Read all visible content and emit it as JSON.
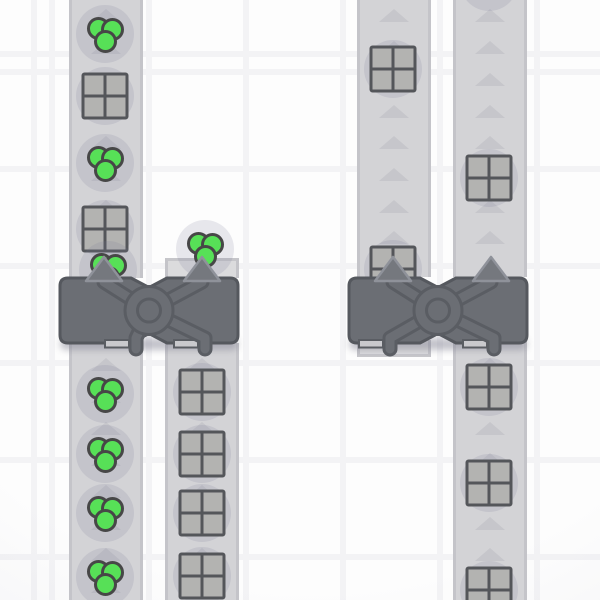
{
  "scene": {
    "title": "factory-belt-scene",
    "tile_size": 97,
    "grid": {
      "vertical_line_xs": [
        52,
        149,
        246,
        343,
        440,
        537
      ],
      "horizontal_line_ys": [
        60,
        157,
        254,
        351,
        448,
        545
      ],
      "line_width": 6,
      "cell_color": "#fdfdfd",
      "line_color": "#f3f3f5"
    },
    "colors": {
      "belt_fill": "#d3d3d6",
      "belt_edge": "#c4c4c9",
      "belt_stub_fill": "#dbdbdd",
      "belt_arrow": "#c6c6cb",
      "item_shadow": "rgba(120,120,148,0.16)",
      "green_item_fill": "#57e057",
      "green_item_outline": "#474747",
      "square_item_fill": "#b3b3b1",
      "square_item_line": "#54565a",
      "balancer_body": "#6b6e74",
      "balancer_outline": "#55585e",
      "balancer_pipe_outline": "#5a5d63",
      "balancer_arrow_fill": "#75787e",
      "balancer_arrow_outline": "#8f929a",
      "balancer_acceptor_fill": "#c9c9cd"
    },
    "arrows": {
      "phase": 10,
      "spacing": 31.7,
      "width": 30,
      "height": 13,
      "direction": "up"
    },
    "belts": [
      {
        "id": "conveyor-belt-1",
        "x": 69,
        "width": 74,
        "segments": [
          {
            "y": 0,
            "h": 278,
            "kind": "belt"
          },
          {
            "y": 343,
            "h": 257,
            "kind": "belt"
          }
        ]
      },
      {
        "id": "conveyor-belt-2",
        "x": 165,
        "width": 74,
        "segments": [
          {
            "y": 258,
            "h": 20,
            "kind": "stub-top"
          },
          {
            "y": 343,
            "h": 257,
            "kind": "belt"
          }
        ]
      },
      {
        "id": "conveyor-belt-3",
        "x": 357,
        "width": 74,
        "segments": [
          {
            "y": 0,
            "h": 277,
            "kind": "belt"
          },
          {
            "y": 340,
            "h": 17,
            "kind": "stub-bottom"
          }
        ]
      },
      {
        "id": "conveyor-belt-4",
        "x": 453,
        "width": 74,
        "segments": [
          {
            "y": 0,
            "h": 277,
            "kind": "belt"
          },
          {
            "y": 340,
            "h": 260,
            "kind": "belt"
          }
        ]
      }
    ],
    "items": [
      {
        "type": "green-circles",
        "x": 105,
        "y": 34
      },
      {
        "type": "gray-square",
        "x": 105,
        "y": 96
      },
      {
        "type": "green-circles",
        "x": 105,
        "y": 163
      },
      {
        "type": "gray-square",
        "x": 105,
        "y": 229
      },
      {
        "type": "green-circles",
        "x": 108,
        "y": 270
      },
      {
        "type": "green-circles",
        "x": 205,
        "y": 249
      },
      {
        "type": "gray-square",
        "x": 393,
        "y": 69
      },
      {
        "type": "gray-square",
        "x": 393,
        "y": 269
      },
      {
        "type": "gray-square",
        "x": 489,
        "y": 178
      },
      {
        "type": "shadow-only",
        "x": 489,
        "y": -18
      },
      {
        "type": "green-circles",
        "x": 105,
        "y": 394
      },
      {
        "type": "green-circles",
        "x": 105,
        "y": 454
      },
      {
        "type": "green-circles",
        "x": 105,
        "y": 513
      },
      {
        "type": "green-circles",
        "x": 105,
        "y": 577
      },
      {
        "type": "gray-square",
        "x": 202,
        "y": 392
      },
      {
        "type": "gray-square",
        "x": 202,
        "y": 454
      },
      {
        "type": "gray-square",
        "x": 202,
        "y": 513
      },
      {
        "type": "gray-square",
        "x": 202,
        "y": 576
      },
      {
        "type": "gray-square",
        "x": 489,
        "y": 387
      },
      {
        "type": "gray-square",
        "x": 489,
        "y": 483
      },
      {
        "type": "gray-square",
        "x": 489,
        "y": 590
      }
    ],
    "balancers": [
      {
        "id": "balancer-left",
        "x": 52,
        "y": 248,
        "width": 194,
        "height": 115,
        "input_arrow_xs": [
          104,
          202
        ],
        "output_stub_xs": [
          136,
          205
        ]
      },
      {
        "id": "balancer-right",
        "x": 341,
        "y": 248,
        "width": 194,
        "height": 115,
        "input_arrow_xs": [
          393,
          491
        ],
        "output_stub_xs": [
          390,
          494
        ]
      }
    ]
  }
}
